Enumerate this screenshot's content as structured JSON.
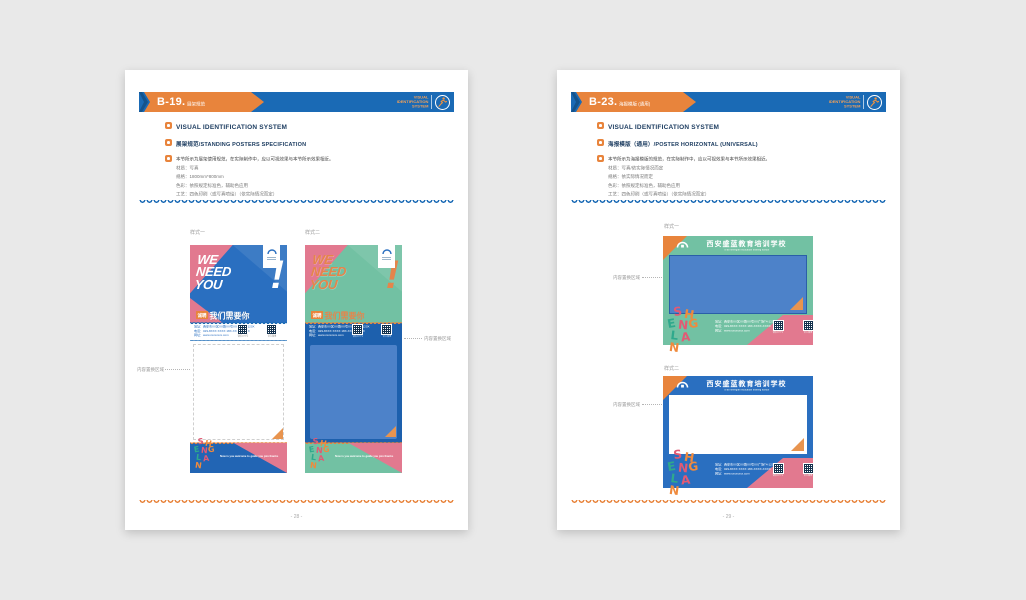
{
  "shared": {
    "vis_heading": "VISUAL IDENTIFICATION SYSTEM",
    "badge_lines": [
      "VISUAL",
      "IDENTIFICATION",
      "SYSTEM"
    ],
    "style1": "样式一",
    "style2": "样式二",
    "anno": "内容置换区域",
    "letters": [
      "S",
      "H",
      "E",
      "N",
      "G",
      "L",
      "A",
      "N"
    ],
    "school_cn": "西安盛蓝教育培训学校",
    "school_en": "Xi'an shenglan education training school",
    "we": "WE",
    "need": "NEED",
    "you": "YOU",
    "excl": "!",
    "chip": "诚聘",
    "recruit_cn": "我们需要你",
    "contact": [
      "地址：西安市XX区XX路XX号XX广场T4-120X",
      "电话：029-8XXX XXXX  18X-XXXX-XXXX",
      "网址：www.xxxxxxxx.com"
    ],
    "slogan": "Now is you welcome to guide you join thanks",
    "qr_wechat": "微信公众号",
    "qr_weibo": "官方微博"
  },
  "pageL": {
    "code": "B-19.",
    "suffix": "展架规范",
    "bullet2": "展架规范/STANDING POSTERS SPECIFICATION",
    "desc": [
      "本节所示为展架使用规范，在实际制作中，应以可视效果与本节所示效果相近。",
      "材质：写真",
      "规格：1800mm*800mm",
      "色彩：依照规定标准色，辅助色应用",
      "工艺：四色印刷（或写真喷绘）（依实际情况而定）"
    ],
    "pagenum": "- 28 -"
  },
  "pageR": {
    "code": "B-23.",
    "suffix": "海报模版 (通用)",
    "bullet2": "海报模版（通用）/POSTER HORIZONTAL (UNIVERSAL)",
    "desc": [
      "本节所示为海报模版的规范，在实际制作中，应以可视效果与本节所示效果相近。",
      "材质：写真/依实际情况而定",
      "规格：依实际情况而定",
      "色彩：依照规定标准色，辅助色应用",
      "工艺：四色印刷（或写真喷绘）（依实际情况而定）"
    ],
    "pagenum": "- 29 -"
  }
}
